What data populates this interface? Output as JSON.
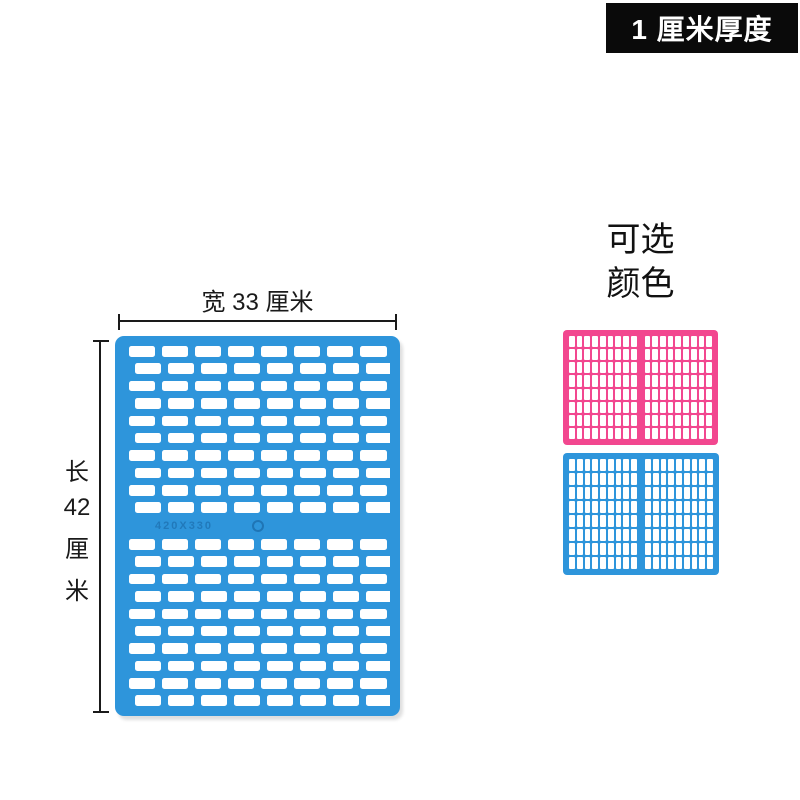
{
  "badge": {
    "label": "1 厘米厚度",
    "bg": "#0a0a0a",
    "text_color": "#ffffff"
  },
  "dimensions": {
    "width_label": "宽 33 厘米",
    "length_parts": [
      "长",
      "42",
      "厘",
      "米"
    ]
  },
  "panel": {
    "color": "#2E95DB",
    "slot_color": "#ffffff",
    "emboss_text": "420X330",
    "grid": {
      "cols": 8,
      "rows_top": 10,
      "rows_bottom": 10
    }
  },
  "color_options": {
    "title_line1": "可选",
    "title_line2": "颜色",
    "swatches": [
      {
        "name": "pink",
        "color": "#F2478F"
      },
      {
        "name": "blue",
        "color": "#2E95DB"
      }
    ],
    "swatch_grid": {
      "rows": 8,
      "cols_per_half": 9
    }
  }
}
